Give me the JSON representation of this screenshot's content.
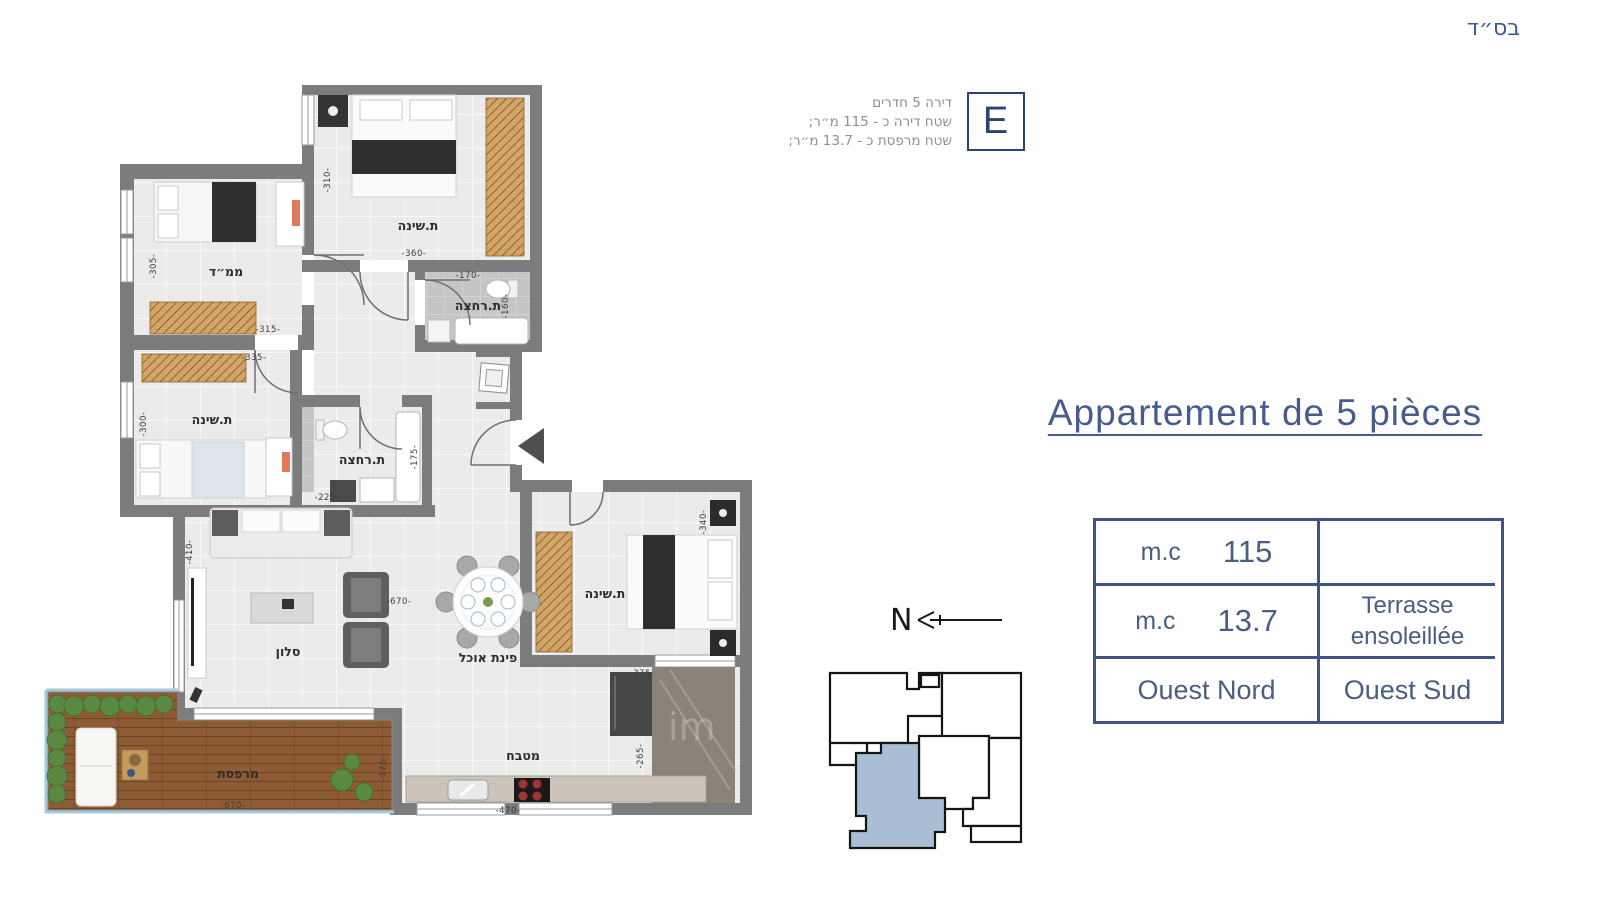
{
  "header": {
    "bsd": "בס״ד"
  },
  "unit_info": {
    "letter": "E",
    "line1": "דירה 5 חדרים",
    "line2": "שטח דירה כ - 115 מ״ר;",
    "line3": "שטח מרפסת כ - 13.7 מ״ר;"
  },
  "title": "Appartement de 5 pièces",
  "table": {
    "r1c1_label": "m.c",
    "r1c1_value": "115",
    "r1c2": "",
    "r2c1_label": "m.c",
    "r2c1_value": "13.7",
    "r2c2_line1": "Terrasse",
    "r2c2_line2": "ensoleillée",
    "r3c1": "Ouest Nord",
    "r3c2": "Ouest Sud"
  },
  "compass": {
    "label": "N"
  },
  "watermark": "im",
  "plan": {
    "rooms": {
      "bedroom_top": "ת.שינה",
      "bath_top": "ת.רחצה",
      "mamad": "ממ״ד",
      "bedroom_mid": "ת.שינה",
      "bath_mid": "ת.רחצה",
      "salon": "סלון",
      "dining": "פינת אוכל",
      "bedroom_right": "ת.שינה",
      "kitchen": "מטבח",
      "terrace": "מרפסת"
    },
    "dims": {
      "d310": "-310-",
      "d360": "-360-",
      "d170": "-170-",
      "d160": "-160-",
      "d305": "-305-",
      "d315": "-315-",
      "d335": "-335-",
      "d300": "-300-",
      "d225": "-225-",
      "d175a": "-175-",
      "d410": "-410-",
      "d670a": "-670-",
      "d340": "-340-",
      "d375": "-375-",
      "d470": "-470-",
      "d265": "-265-",
      "d670b": "-670-",
      "d175b": "-175-"
    }
  },
  "colors": {
    "accent_blue": "#42598c",
    "navy": "#2c4271",
    "wall_gray": "#7c7c7c",
    "keyplan_highlight": "#a9bed5",
    "deck_wood": "#8d5c36",
    "closet_wood": "#d2a566"
  }
}
